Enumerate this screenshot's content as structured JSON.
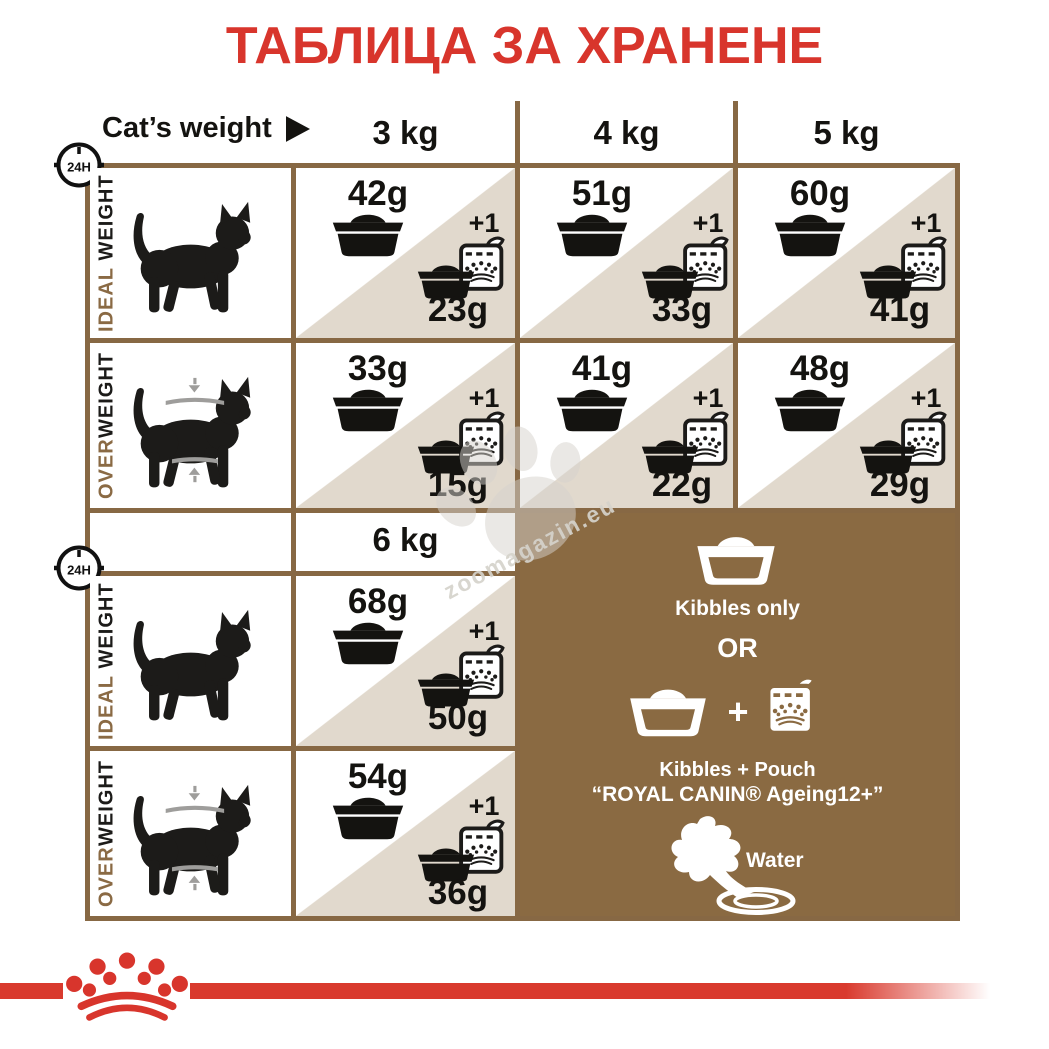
{
  "title": "ТАБЛИЦА ЗА ХРАНЕНЕ",
  "clock_label": "24H",
  "header": {
    "label": "Cat’s weight"
  },
  "columns": {
    "c3": "3 kg",
    "c4": "4 kg",
    "c5": "5 kg",
    "c6": "6 kg"
  },
  "row_labels": {
    "ideal": {
      "accent": "IDEAL",
      "rest": " WEIGHT"
    },
    "over": {
      "accent": "OVER",
      "rest": "WEIGHT"
    }
  },
  "plus_one": "+1",
  "cells": {
    "ideal_3": {
      "kibbles": "42g",
      "mix": "23g"
    },
    "ideal_4": {
      "kibbles": "51g",
      "mix": "33g"
    },
    "ideal_5": {
      "kibbles": "60g",
      "mix": "41g"
    },
    "over_3": {
      "kibbles": "33g",
      "mix": "15g"
    },
    "over_4": {
      "kibbles": "41g",
      "mix": "22g"
    },
    "over_5": {
      "kibbles": "48g",
      "mix": "29g"
    },
    "ideal_6": {
      "kibbles": "68g",
      "mix": "50g"
    },
    "over_6": {
      "kibbles": "54g",
      "mix": "36g"
    }
  },
  "panel": {
    "kibbles_only": "Kibbles only",
    "or": "OR",
    "plus": "+",
    "kibbles_pouch": "Kibbles + Pouch",
    "pouch_name": "“ROYAL CANIN® Ageing12+”",
    "water": "Water"
  },
  "watermark": "zoomagazin.eu",
  "colors": {
    "red": "#d8352c",
    "brown": "#8a6a44",
    "beige": "#e1d9cd",
    "panel_brown": "#8a6a42"
  }
}
